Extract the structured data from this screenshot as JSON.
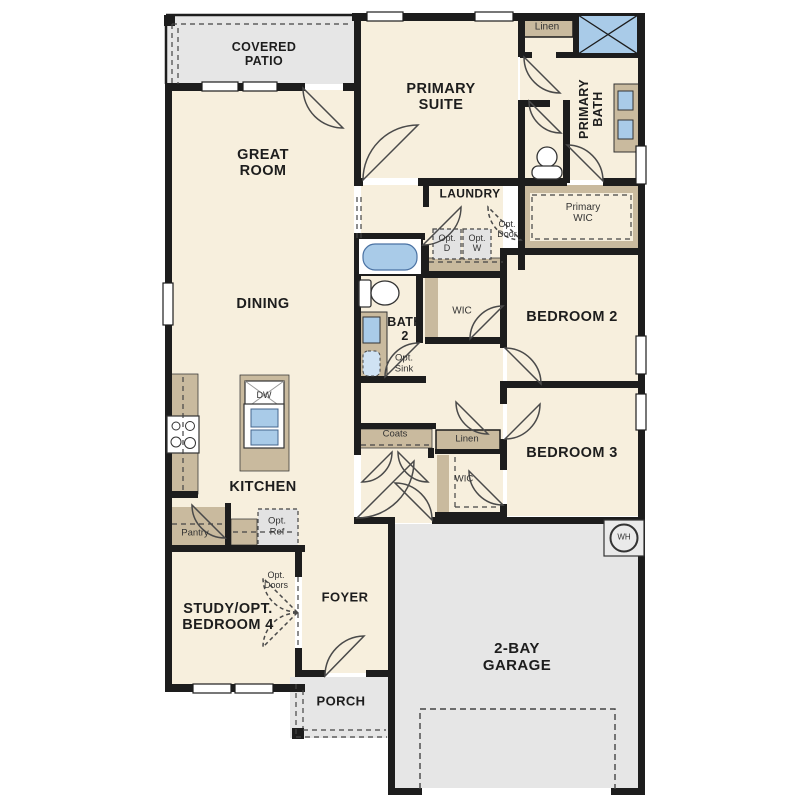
{
  "meta": {
    "kind": "single-story floor plan",
    "canvas_w": 810,
    "canvas_h": 810
  },
  "colors": {
    "floor_cream": "#f7efdd",
    "outdoor_gray": "#e6e6e6",
    "casework_tan": "#c9ba9e",
    "fixture_blue": "#a9cbe8",
    "wall_black": "#1d1d1d"
  },
  "rooms": {
    "covered_patio": "COVERED\nPATIO",
    "great_room": "GREAT\nROOM",
    "primary_suite": "PRIMARY\nSUITE",
    "primary_bath": "PRIMARY\nBATH",
    "linen_upper": "Linen",
    "primary_wic": "Primary\nWIC",
    "laundry": "LAUNDRY",
    "dining": "DINING",
    "bath2": "BATH\n2",
    "wic_bath": "WIC",
    "bedroom2": "BEDROOM 2",
    "bedroom3": "BEDROOM 3",
    "coats": "Coats",
    "linen_hall": "Linen",
    "wic_hall": "WIC",
    "kitchen": "KITCHEN",
    "pantry": "Pantry",
    "study": "STUDY/OPT.\nBEDROOM 4",
    "foyer": "FOYER",
    "porch": "PORCH",
    "garage": "2-BAY\nGARAGE"
  },
  "annotations": {
    "opt_door": "Opt.\nDoor",
    "opt_dryer": "Opt.\nD",
    "opt_washer": "Opt.\nW",
    "opt_sink": "Opt.\nSink",
    "opt_ref": "Opt.\nRef",
    "opt_doors": "Opt.\nDoors",
    "dishwasher": "DW",
    "water_heater": "WH"
  }
}
